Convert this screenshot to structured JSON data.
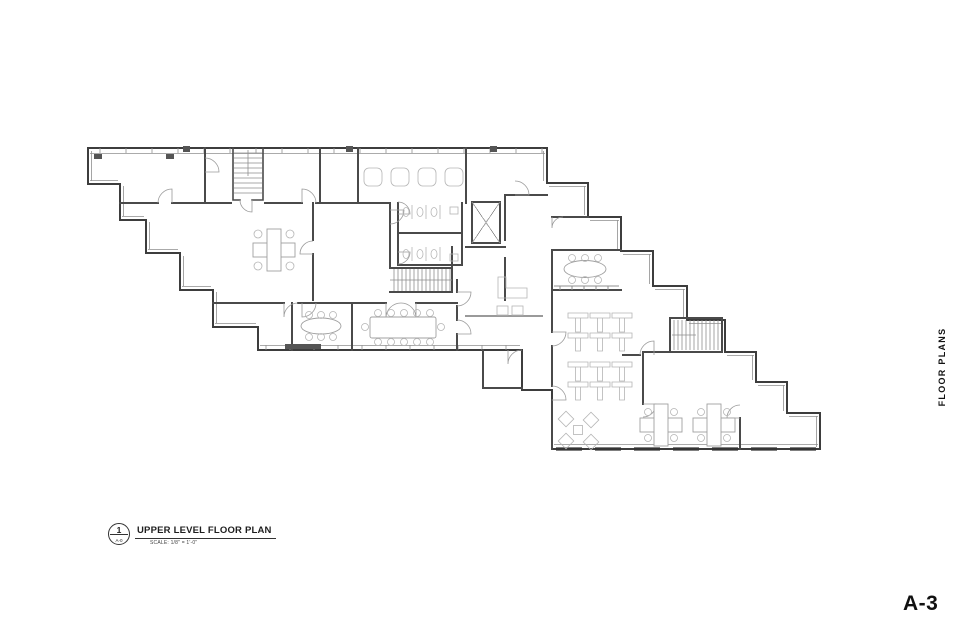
{
  "sheet": {
    "side_label": "FLOOR PLANS",
    "number": "A-3"
  },
  "title_block": {
    "detail_number": "1",
    "detail_sheet_ref": "A-0",
    "title": "UPPER LEVEL FLOOR PLAN",
    "scale": "SCALE: 1/8\" = 1'-0\""
  },
  "drawing": {
    "description": "Stepped upper level office floor plan with three stairs, elevator, restrooms, conference rooms and open office desk clusters",
    "colors": {
      "background": "#ffffff",
      "walls": "#3d3d3d",
      "glass": "#8f8f8f",
      "furniture": "#a8a8a8",
      "text": "#111111"
    }
  }
}
